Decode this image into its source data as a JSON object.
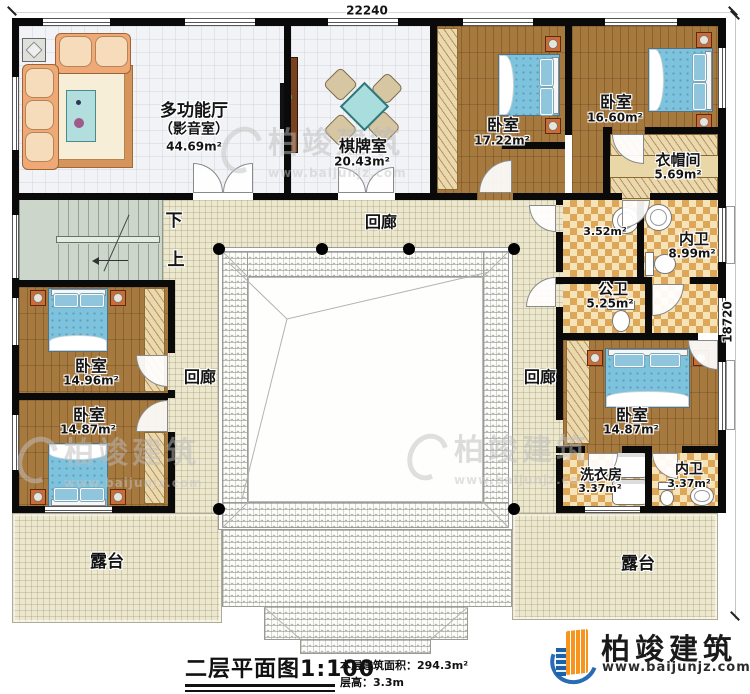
{
  "dimensions": {
    "top": "22240",
    "right": "18720"
  },
  "stairs": {
    "down": "下",
    "up": "上"
  },
  "corridor_label": "回廊",
  "terrace_label": "露台",
  "rooms": {
    "multi_hall": {
      "name": "多功能厅",
      "alt": "（影音室）",
      "area": "44.69m²"
    },
    "chess": {
      "name": "棋牌室",
      "area": "20.43m²"
    },
    "bed_a": {
      "name": "卧室",
      "area": "17.22m²"
    },
    "bed_b": {
      "name": "卧室",
      "area": "16.60m²"
    },
    "cloak": {
      "name": "衣帽间",
      "area": "5.69m²"
    },
    "wash_area": {
      "area": "3.52m²"
    },
    "bath_top": {
      "name": "内卫",
      "area": "8.99m²"
    },
    "bath_public": {
      "name": "公卫",
      "area": "5.25m²"
    },
    "bed_right": {
      "name": "卧室",
      "area": "14.87m²"
    },
    "laundry": {
      "name": "洗衣房",
      "area": "3.37m²"
    },
    "bath_bottom": {
      "name": "内卫",
      "area": "3.37m²"
    },
    "bed_mid_left": {
      "name": "卧室",
      "area": "14.96m²"
    },
    "bed_bottom_left": {
      "name": "卧室",
      "area": "14.87m²"
    }
  },
  "titleblock": {
    "title": "二层平面图",
    "scale": "1:100",
    "area_line": "本层建筑面积：294.3m²",
    "height_line": "层高：3.3m"
  },
  "brand": {
    "name": "柏竣建筑",
    "url": "www.baijunjz.com"
  },
  "watermark": {
    "name": "柏竣建筑",
    "url": "www.baijunjz.com"
  }
}
